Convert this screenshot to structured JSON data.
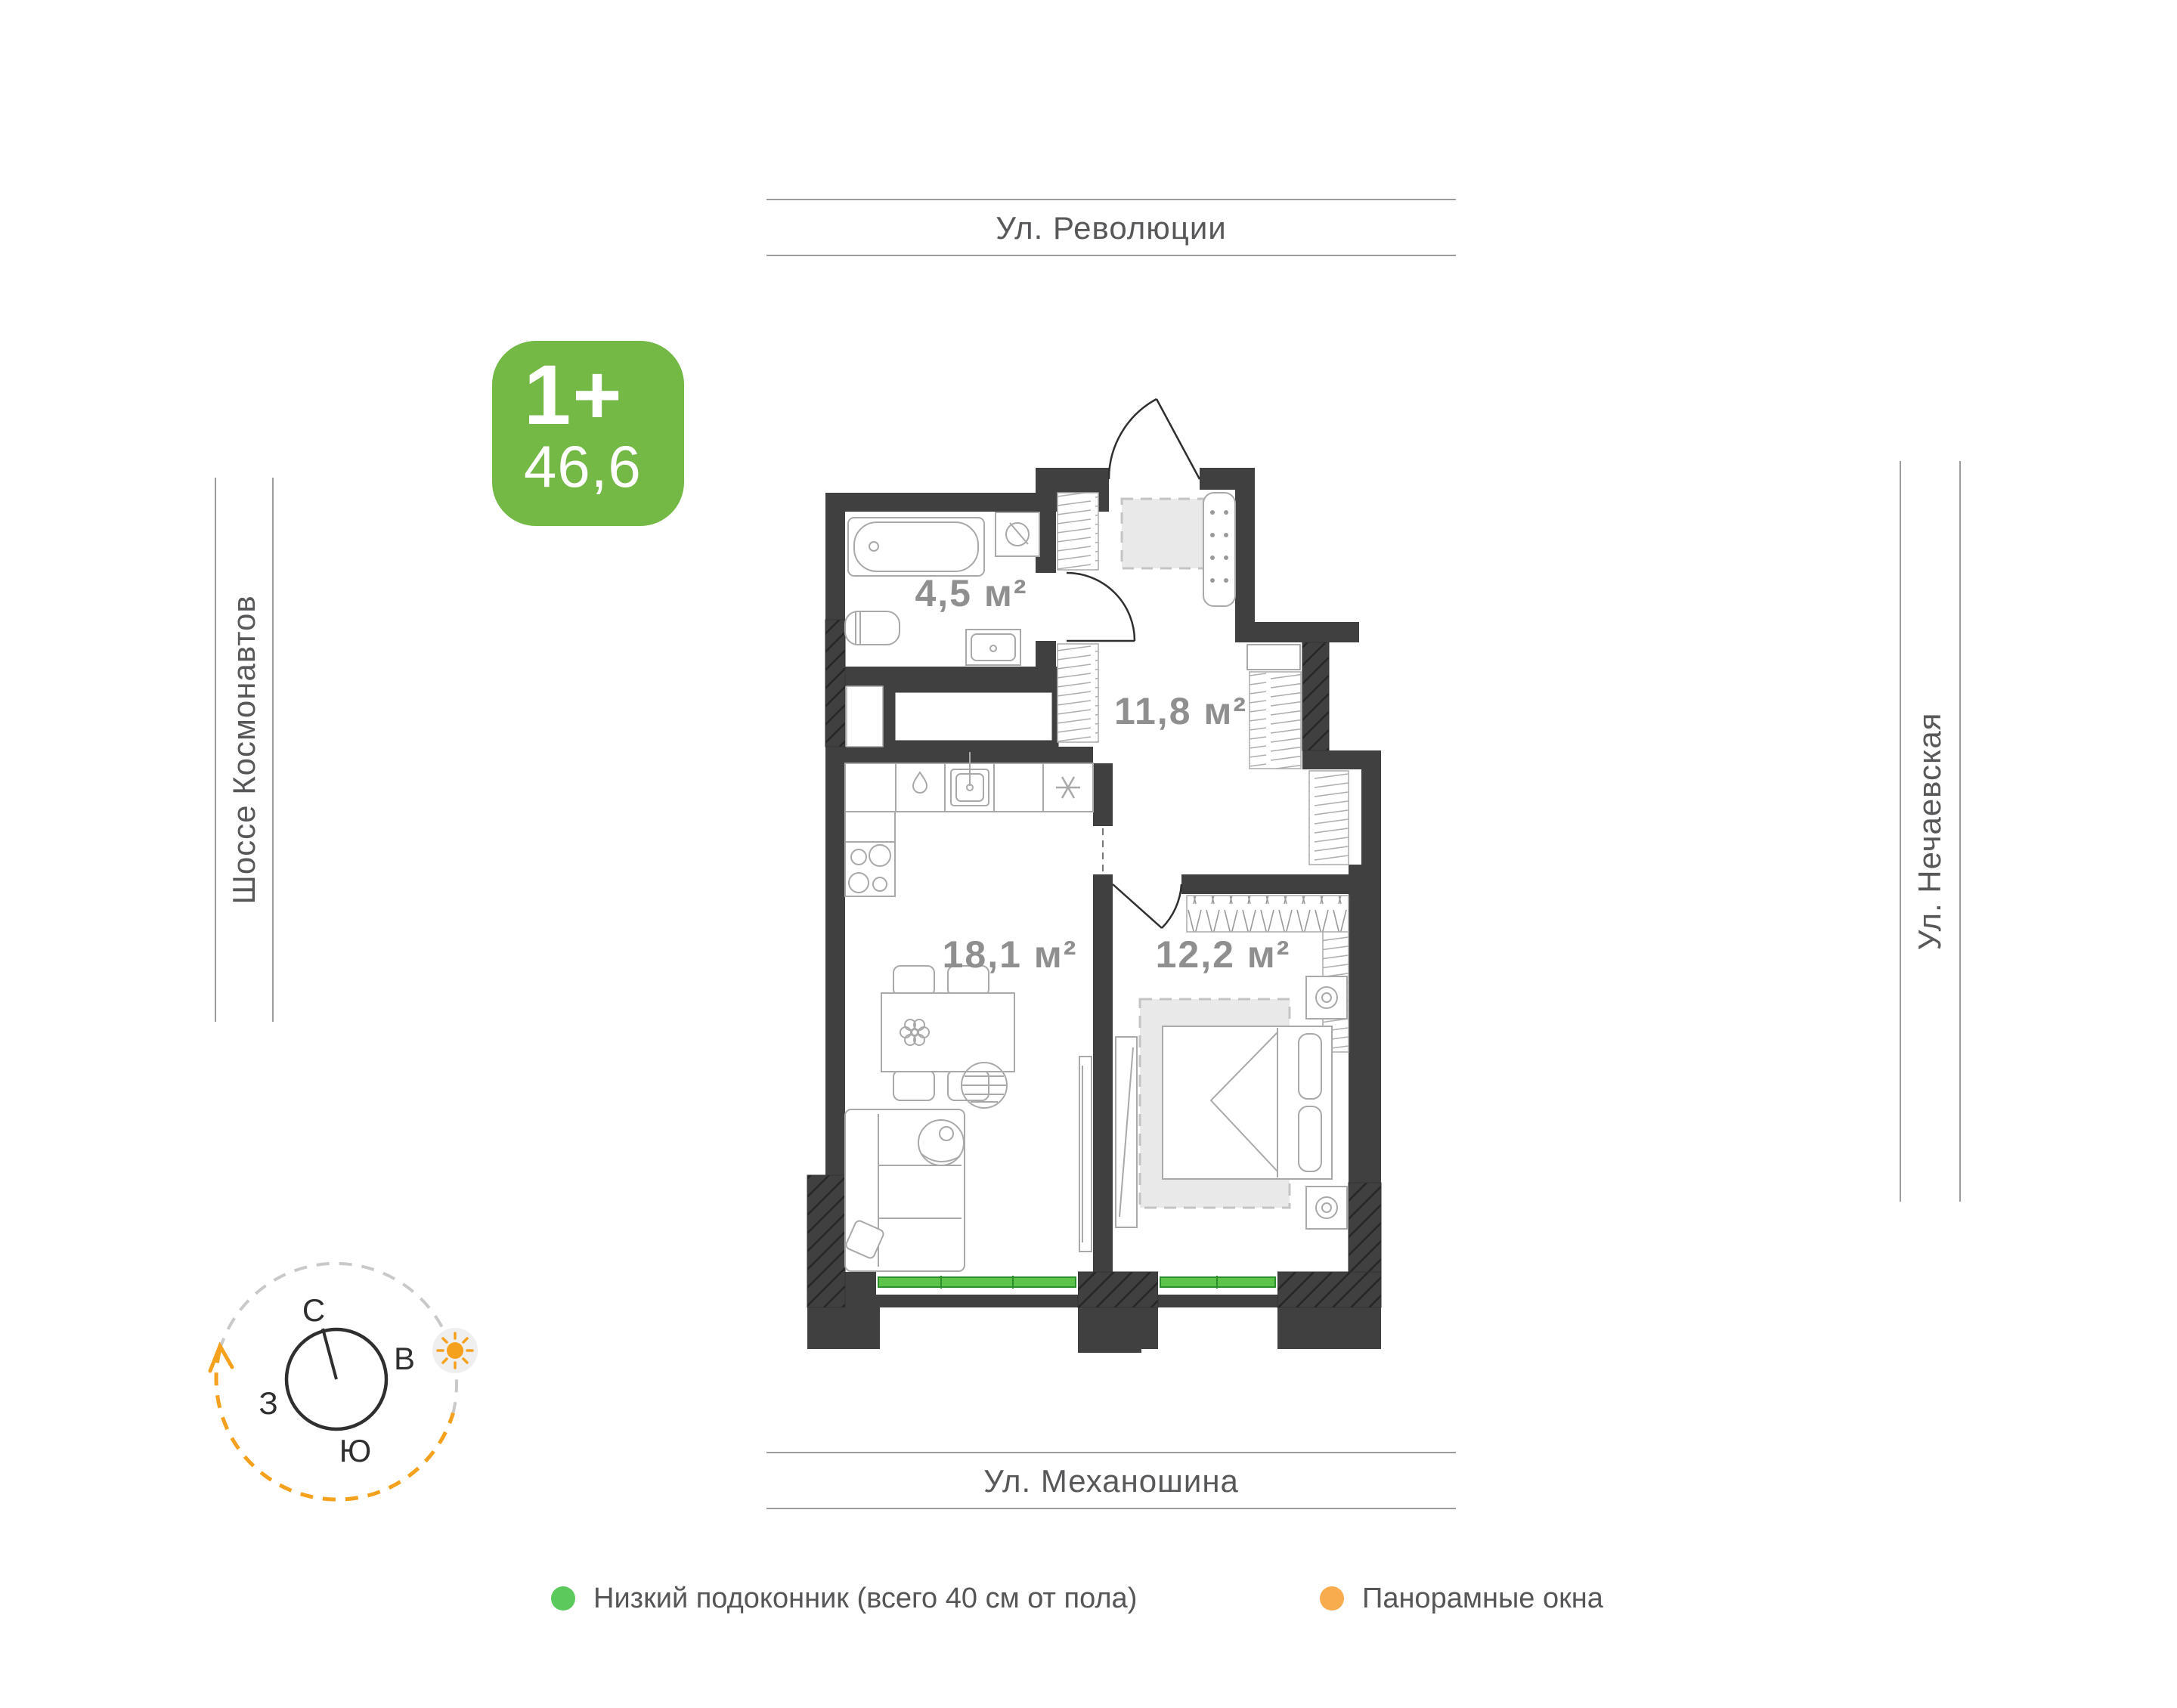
{
  "streets": {
    "top": "Ул. Революции",
    "bottom": "Ул. Механошина",
    "left": "Шоссе Космонавтов",
    "right": "Ул. Нечаевская"
  },
  "badge": {
    "rooms": "1+",
    "area": "46,6"
  },
  "plan": {
    "rooms": [
      {
        "id": "bathroom",
        "area": "4,5 м²"
      },
      {
        "id": "hallway",
        "area": "11,8 м²"
      },
      {
        "id": "living-kitchen",
        "area": "18,1 м²"
      },
      {
        "id": "bedroom",
        "area": "12,2 м²"
      }
    ]
  },
  "compass": {
    "north": "С",
    "east": "В",
    "west": "З",
    "south": "Ю"
  },
  "legend": {
    "items": [
      {
        "label": "Низкий подоконник (всего 40 см от пола)",
        "color": "#5cc95c"
      },
      {
        "label": "Панорамные окна",
        "color": "#f8ac4e"
      }
    ]
  },
  "colors": {
    "wall": "#404040",
    "badge_green": "#74b845",
    "window_green": "#5cc44a",
    "compass_orange": "#f5a11d",
    "legend_green": "#5cc95c",
    "legend_orange": "#f8ac4e"
  },
  "icons": {
    "sun-icon": "sun",
    "snowflake-icon": "asterisk",
    "drop-icon": "water-drop",
    "plant-icon": "flower"
  }
}
